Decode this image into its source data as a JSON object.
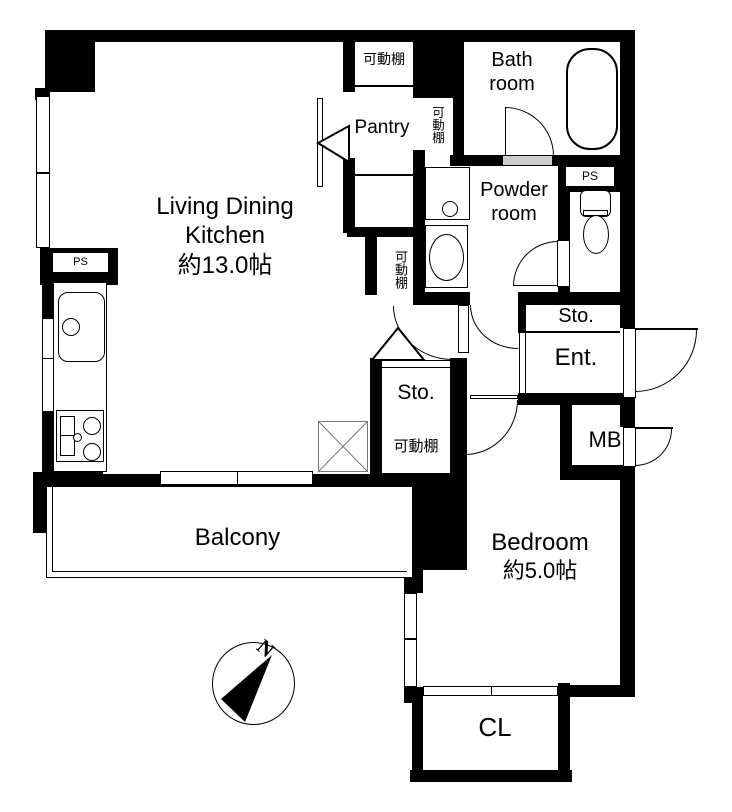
{
  "labels": {
    "living_dining": "Living Dining",
    "kitchen": "Kitchen",
    "ldk_size": "約13.0帖",
    "bath1": "Bath",
    "bath2": "room",
    "powder1": "Powder",
    "powder2": "room",
    "pantry": "Pantry",
    "movable_shelf": "可動棚",
    "ps": "PS",
    "sto": "Sto.",
    "ent": "Ent.",
    "mb": "MB",
    "bedroom": "Bedroom",
    "bedroom_size": "約5.0帖",
    "balcony": "Balcony",
    "closet": "CL",
    "north": "N"
  },
  "rooms": [
    {
      "name": "Living Dining Kitchen",
      "size": "約13.0帖"
    },
    {
      "name": "Bedroom",
      "size": "約5.0帖"
    },
    {
      "name": "Bath room"
    },
    {
      "name": "Powder room"
    },
    {
      "name": "Pantry"
    },
    {
      "name": "Balcony"
    },
    {
      "name": "CL"
    },
    {
      "name": "Ent."
    },
    {
      "name": "Sto."
    },
    {
      "name": "MB"
    },
    {
      "name": "PS"
    }
  ],
  "colors": {
    "wall": "#000000",
    "floor": "#ffffff",
    "threshold": "#cccccc",
    "xbox_line": "#777777"
  }
}
